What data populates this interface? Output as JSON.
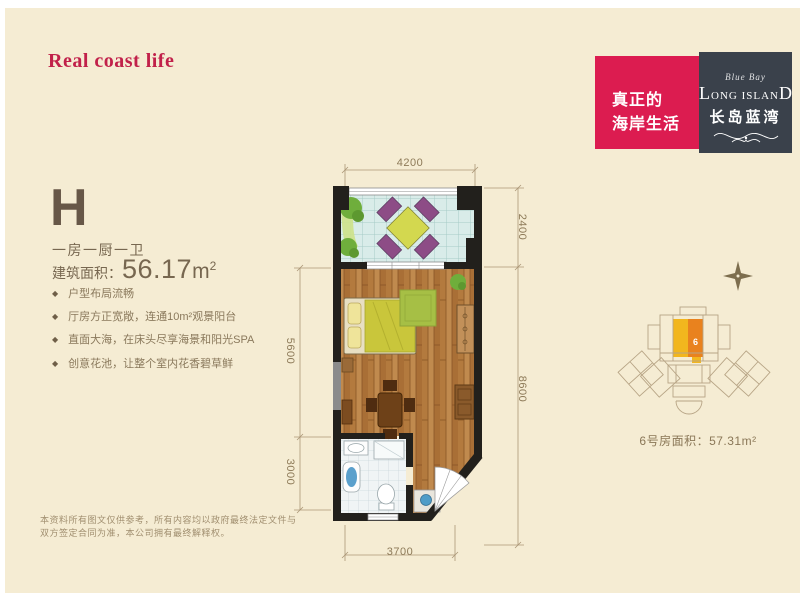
{
  "header": {
    "tagline": "Real coast life"
  },
  "brand": {
    "slogan_line1": "真正的",
    "slogan_line2": "海岸生活",
    "script_name": "Blue Bay",
    "name_first": "L",
    "name_mid": "ONG ISLAN",
    "name_last": "D",
    "name_cn": "长岛蓝湾"
  },
  "unit": {
    "type_code": "H",
    "layout": "一房一厨一卫",
    "area_label": "建筑面积：",
    "area_value": "56.17",
    "area_unit": "m",
    "area_exp": "2",
    "bullet": "◆",
    "features": [
      "户型布局流畅",
      "厅房方正宽敞，连通10m²观景阳台",
      "直面大海，在床头尽享海景和阳光SPA",
      "创意花池，让整个室内花香碧草鲜"
    ]
  },
  "floorplan": {
    "dim_top": "4200",
    "dim_right_balcony": "2400",
    "dim_right_total": "8600",
    "dim_left_main": "5600",
    "dim_left_bath": "3000",
    "dim_bottom": "3700"
  },
  "siteplan": {
    "unit_number": "6",
    "caption": "6号房面积：57.31m²"
  },
  "disclaimer": {
    "line1": "本资料所有图文仅供参考，所有内容均以政府最终法定文件与",
    "line2": "双方签定合同为准，本公司拥有最终解释权。"
  },
  "colors": {
    "background": "#f5ecd3",
    "accent_red": "#dc1c50",
    "brand_dark": "#3a414b",
    "text_brown": "#776750",
    "highlight_yellow": "#f2b61e",
    "highlight_orange": "#e9821e"
  }
}
